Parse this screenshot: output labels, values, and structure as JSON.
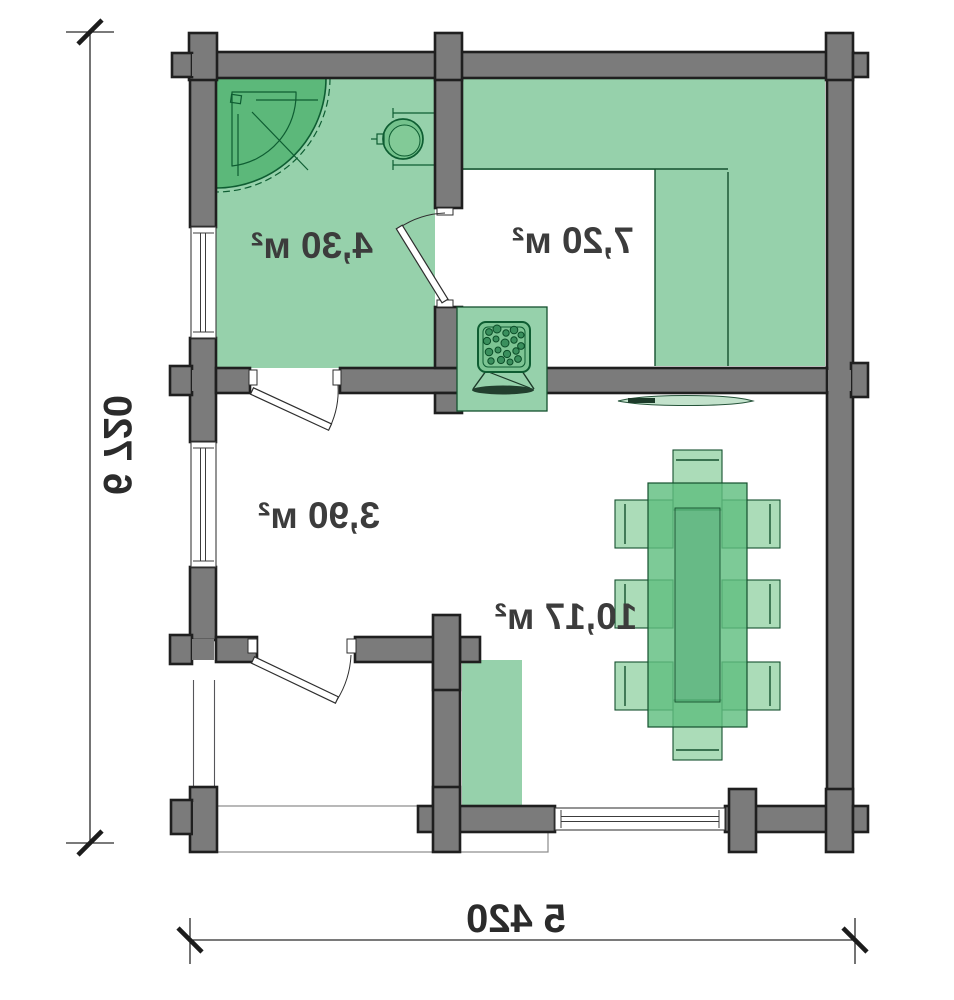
{
  "plan": {
    "type": "floor-plan",
    "rooms": [
      {
        "id": "bathroom",
        "area_label": "4,30 м²"
      },
      {
        "id": "sauna",
        "area_label": "7,20 м²"
      },
      {
        "id": "hall",
        "area_label": "3,90 м²"
      },
      {
        "id": "lounge",
        "area_label": "10,17 м²"
      }
    ],
    "dimensions": {
      "overall_height": "6 720",
      "overall_width": "5 420"
    },
    "fixtures": [
      "shower-tray",
      "washbasin",
      "sauna-stove",
      "two-tier-sauna-bench",
      "dining-table",
      "side-chairs",
      "end-seats",
      "cabinet",
      "bench-board"
    ],
    "colors": {
      "wall_fill": "#7b7b7b",
      "wall_outline": "#1f1f1f",
      "room_green": "#96d1ab",
      "fixture_green": "#5cb87a",
      "fixture_outline": "#0e5d32",
      "label_text": "#3c3c3c",
      "dimension_text": "#2b2b2b"
    },
    "style": {
      "text_mirrored": true
    }
  }
}
